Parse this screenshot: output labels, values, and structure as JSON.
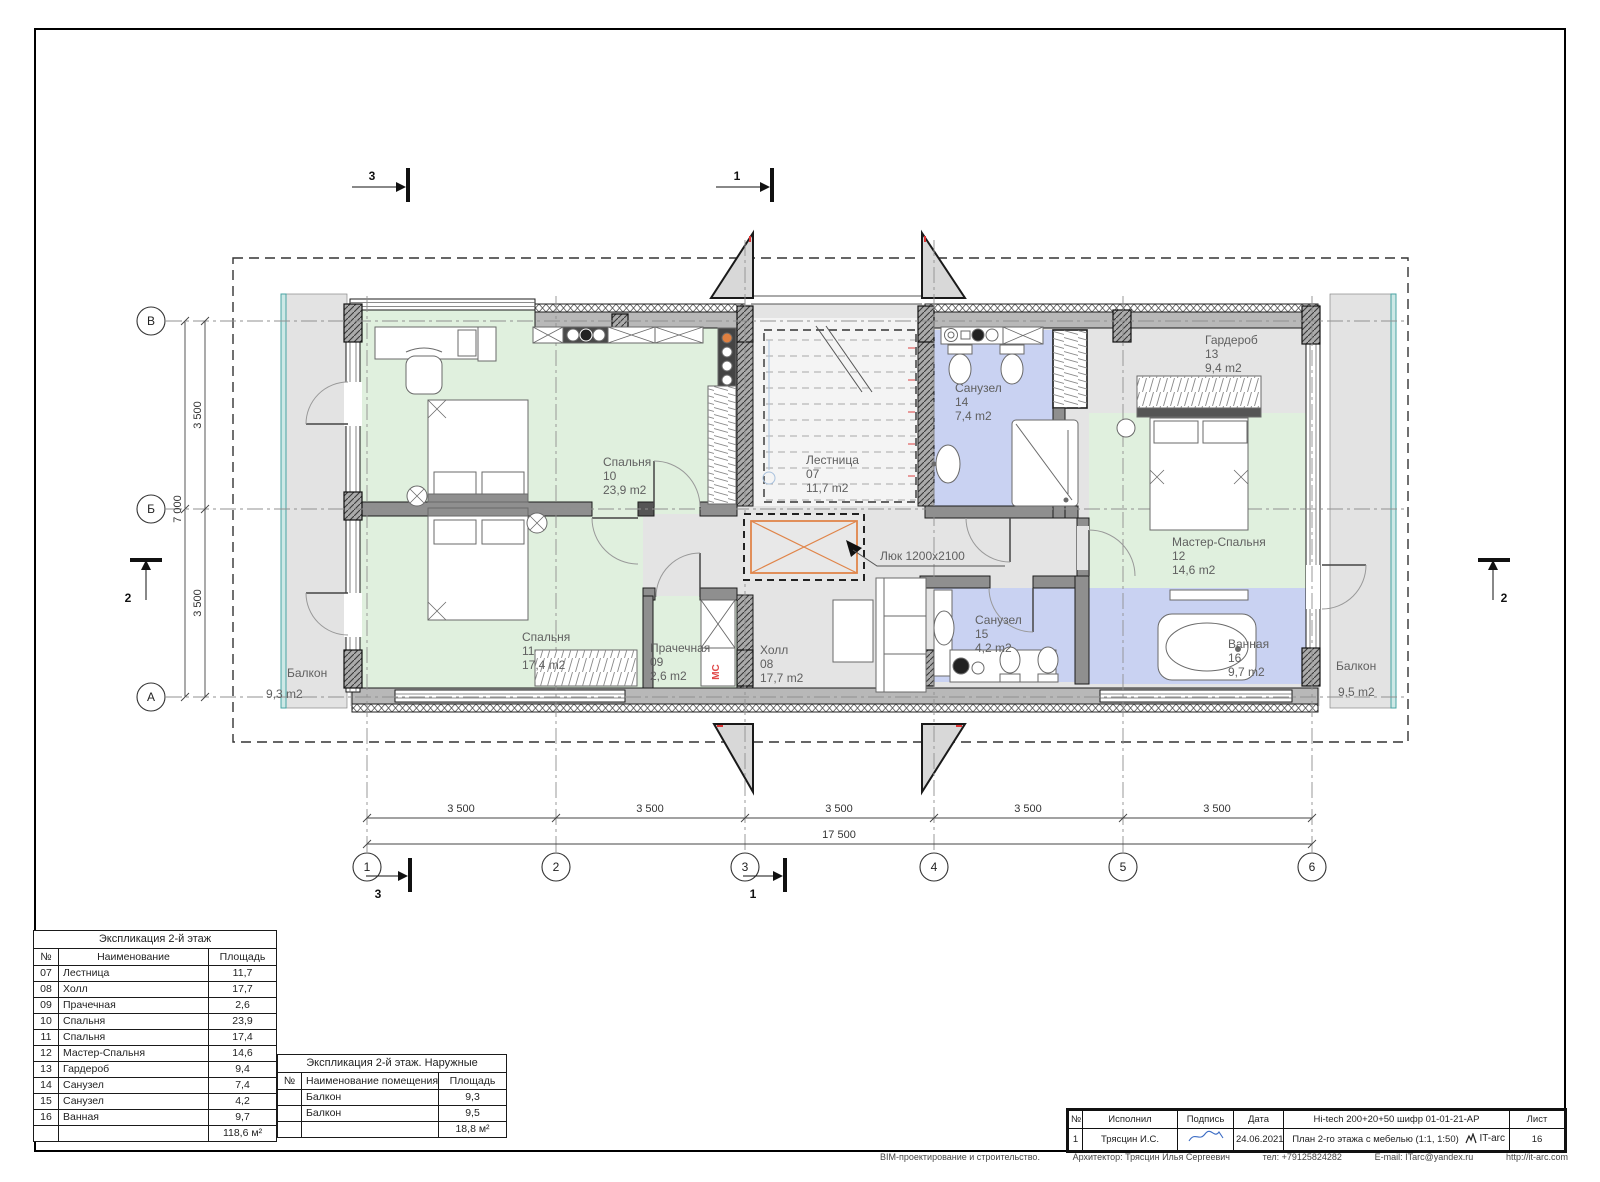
{
  "plan": {
    "rooms": {
      "bedroom10": {
        "name": "Спальня",
        "num": "10",
        "area": "23,9 m2"
      },
      "bedroom11": {
        "name": "Спальня",
        "num": "11",
        "area": "17,4 m2"
      },
      "laundry09": {
        "name": "Прачечная",
        "num": "09",
        "area": "2,6 m2"
      },
      "stairs07": {
        "name": "Лестница",
        "num": "07",
        "area": "11,7 m2"
      },
      "hall08": {
        "name": "Холл",
        "num": "08",
        "area": "17,7 m2"
      },
      "wc14": {
        "name": "Санузел",
        "num": "14",
        "area": "7,4 m2"
      },
      "wc15": {
        "name": "Санузел",
        "num": "15",
        "area": "4,2 m2"
      },
      "wardrobe13": {
        "name": "Гардероб",
        "num": "13",
        "area": "9,4 m2"
      },
      "master12": {
        "name": "Мастер-Спальня",
        "num": "12",
        "area": "14,6 m2"
      },
      "bath16": {
        "name": "Ванная",
        "num": "16",
        "area": "9,7 m2"
      },
      "balconyL": {
        "name": "Балкон",
        "area": "9,3 m2"
      },
      "balconyR": {
        "name": "Балкон",
        "area": "9,5 m2"
      }
    },
    "hatch_label": "Люк 1200х2100",
    "mc_label": "МС",
    "axes": {
      "cols": [
        "1",
        "2",
        "3",
        "4",
        "5",
        "6"
      ],
      "rows": [
        "В",
        "Б",
        "А"
      ]
    },
    "dims": {
      "spans": [
        "3 500",
        "3 500",
        "3 500",
        "3 500",
        "3 500"
      ],
      "total_w": "17 500",
      "vspans": [
        "3 500",
        "3 500"
      ],
      "total_h": "7 000"
    },
    "sections": {
      "one": "1",
      "two": "2",
      "three": "3"
    }
  },
  "tables": {
    "main": {
      "title": "Экспликация 2-й этаж",
      "headers": [
        "№",
        "Наименование",
        "Площадь"
      ],
      "rows": [
        [
          "07",
          "Лестница",
          "11,7"
        ],
        [
          "08",
          "Холл",
          "17,7"
        ],
        [
          "09",
          "Прачечная",
          "2,6"
        ],
        [
          "10",
          "Спальня",
          "23,9"
        ],
        [
          "11",
          "Спальня",
          "17,4"
        ],
        [
          "12",
          "Мастер-Спальня",
          "14,6"
        ],
        [
          "13",
          "Гардероб",
          "9,4"
        ],
        [
          "14",
          "Санузел",
          "7,4"
        ],
        [
          "15",
          "Санузел",
          "4,2"
        ],
        [
          "16",
          "Ванная",
          "9,7"
        ]
      ],
      "total": "118,6 м²"
    },
    "outer": {
      "title": "Экспликация 2-й этаж. Наружные",
      "headers": [
        "№",
        "Наименование помещения",
        "Площадь"
      ],
      "rows": [
        [
          "",
          "Балкон",
          "9,3"
        ],
        [
          "",
          "Балкон",
          "9,5"
        ]
      ],
      "total": "18,8 м²"
    }
  },
  "titleblock": {
    "h_num": "№",
    "h_exec": "Исполнил",
    "h_sign": "Подпись",
    "h_date": "Дата",
    "h_proj": "Hi-tech 200+20+50  шифр 01-01-21-АР",
    "h_sheet": "Лист",
    "r_num": "1",
    "r_exec": "Трясцин И.С.",
    "r_date": "24.06.2021",
    "r_doc": "План 2-го этажа с мебелью (1:1, 1:50)",
    "r_logo": "IT-arc",
    "r_sheet": "16"
  },
  "footer": {
    "company": "BIM-проектирование и строительство.",
    "architect": "Архитектор: Трясцин Илья Сергеевич",
    "phone": "тел: +79125824282",
    "email": "E-mail: ITarc@yandex.ru",
    "site": "http://it-arc.com"
  }
}
